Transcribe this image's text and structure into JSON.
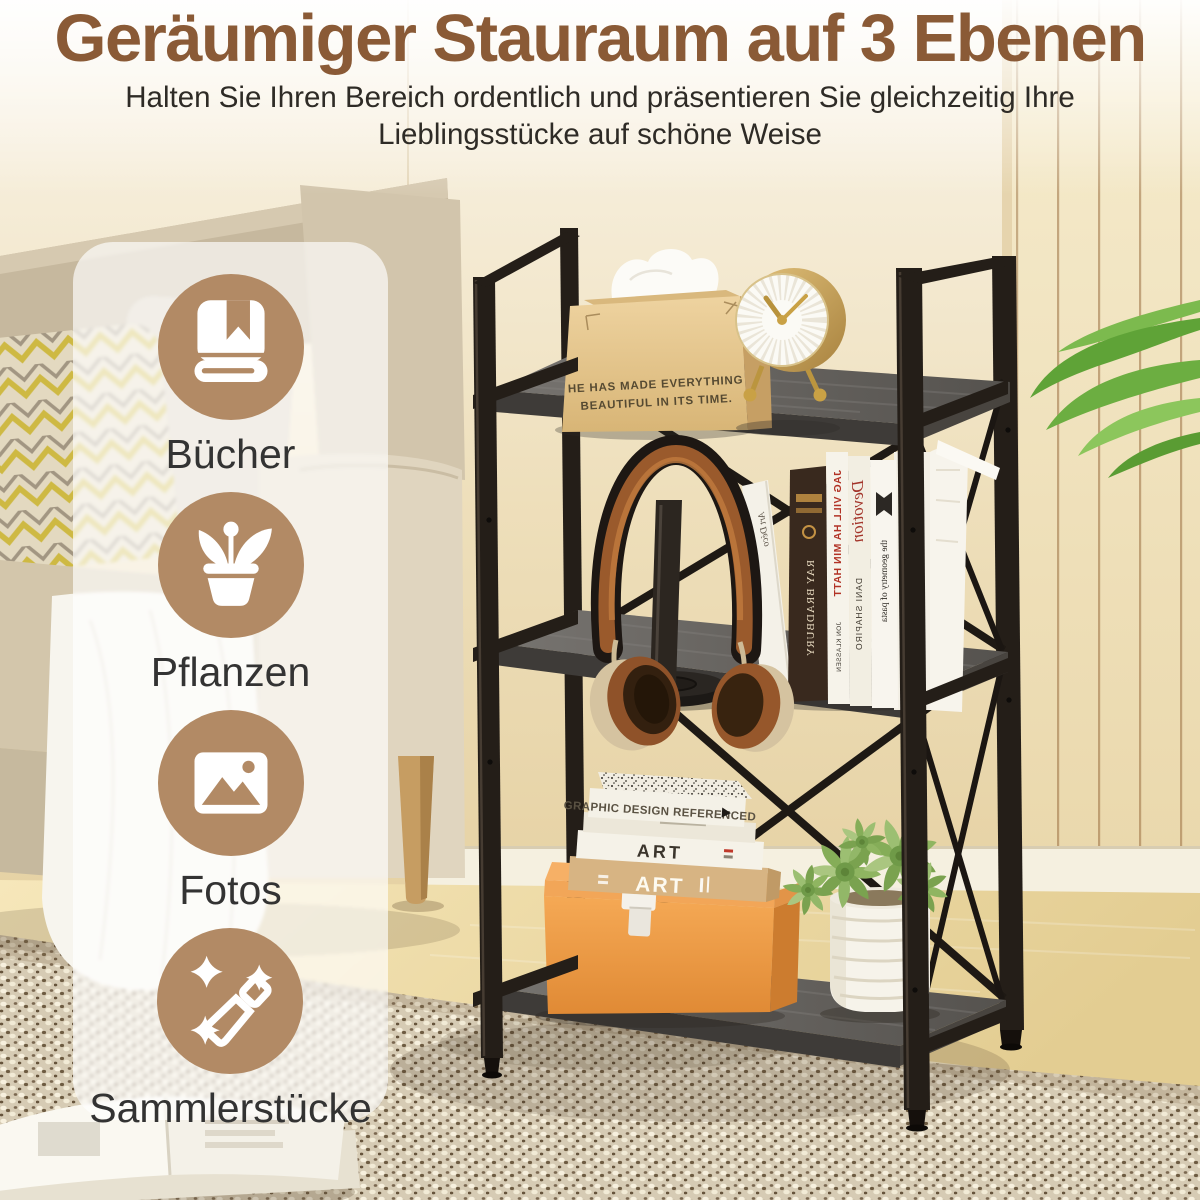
{
  "header": {
    "title": "Geräumiger Stauraum auf 3 Ebenen",
    "subtitle_line1": "Halten Sie Ihren Bereich ordentlich und präsentieren Sie gleichzeitig Ihre",
    "subtitle_line2": "Lieblingsstücke auf schöne Weise"
  },
  "categories": {
    "items": [
      {
        "label": "Bücher",
        "icon": "book-icon"
      },
      {
        "label": "Pflanzen",
        "icon": "potted-plant-icon"
      },
      {
        "label": "Fotos",
        "icon": "photo-icon"
      },
      {
        "label": "Sammlerstücke",
        "icon": "magic-wand-icon"
      }
    ]
  },
  "scene": {
    "tissue_box": {
      "quote_line1": "HE HAS MADE EVERYTHING",
      "quote_line2": "BEAUTIFUL IN ITS TIME."
    },
    "middle_shelf_books": {
      "book1_spine": "Art Déco",
      "book2_spine": "RAY BRADBURY",
      "book3_spine": "JAG VILL HA MIN HATT",
      "book3_author": "JON KLASSEN",
      "book4_spine": "Devotion",
      "book4_author": "DANI SHAPIRO",
      "book5_spine": "the geometry of pasta"
    },
    "bottom_shelf_books": {
      "top_book_spine": "GRAPHIC DESIGN REFERENCED",
      "middle_book_spine": "ART",
      "bottom_book_spine": "ART"
    }
  },
  "colors": {
    "title_brown": "#8A5A36",
    "subtitle_gray": "#2E2B26",
    "icon_circle_brown": "#B28A65",
    "metal_frame_black": "#241E18",
    "shelf_wood_gray": "#5E5B57",
    "storage_box_orange": "#E89140",
    "clock_gold": "#C9A145"
  }
}
